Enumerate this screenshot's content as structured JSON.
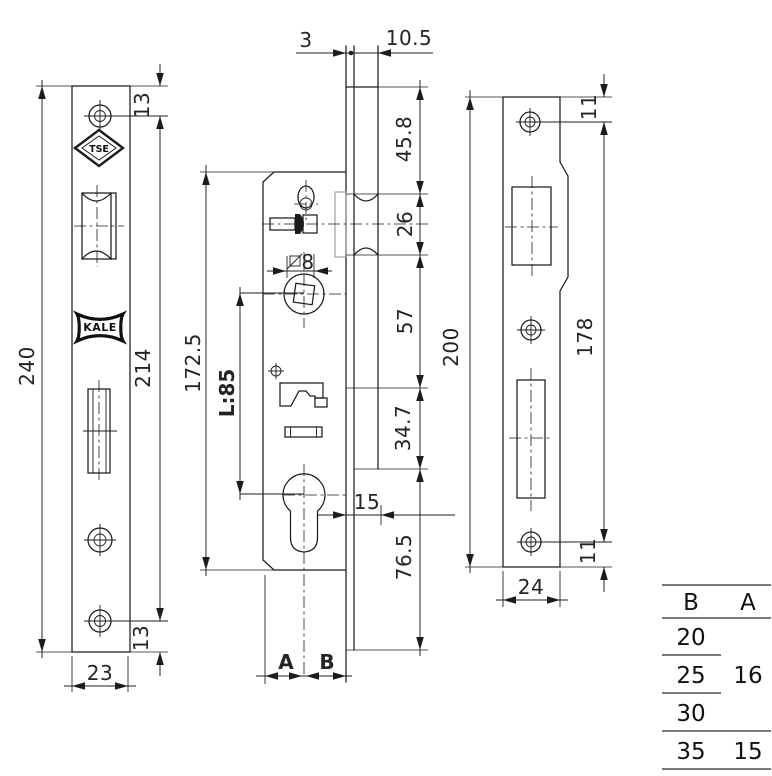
{
  "ink": "#1c1c1c",
  "logos": {
    "tse": "TSE",
    "kale": "KALE"
  },
  "faceplate_view": {
    "length": "240",
    "hole_span": "214",
    "hole_offset_top": "13",
    "hole_offset_bottom": "13",
    "width": "23"
  },
  "body_view": {
    "plate_thickness": "3",
    "case_offset": "10.5",
    "top_to_latch": "45.8",
    "latch_height": "26",
    "latch_to_spindle": "57",
    "spindle_zone": "34.7",
    "bottom_zone": "76.5",
    "case_length": "172.5",
    "centres": "L:85",
    "square": "8",
    "front_gap": "15",
    "dim_a": "A",
    "dim_b": "B"
  },
  "strike_view": {
    "length": "200",
    "hole_span": "178",
    "hole_offset_top": "11",
    "hole_offset_bottom": "11",
    "width": "24"
  },
  "size_table": {
    "header_b": "B",
    "header_a": "A",
    "rows_b": [
      "20",
      "25",
      "30",
      "35"
    ],
    "a_shared": "16",
    "a_last": "15"
  }
}
